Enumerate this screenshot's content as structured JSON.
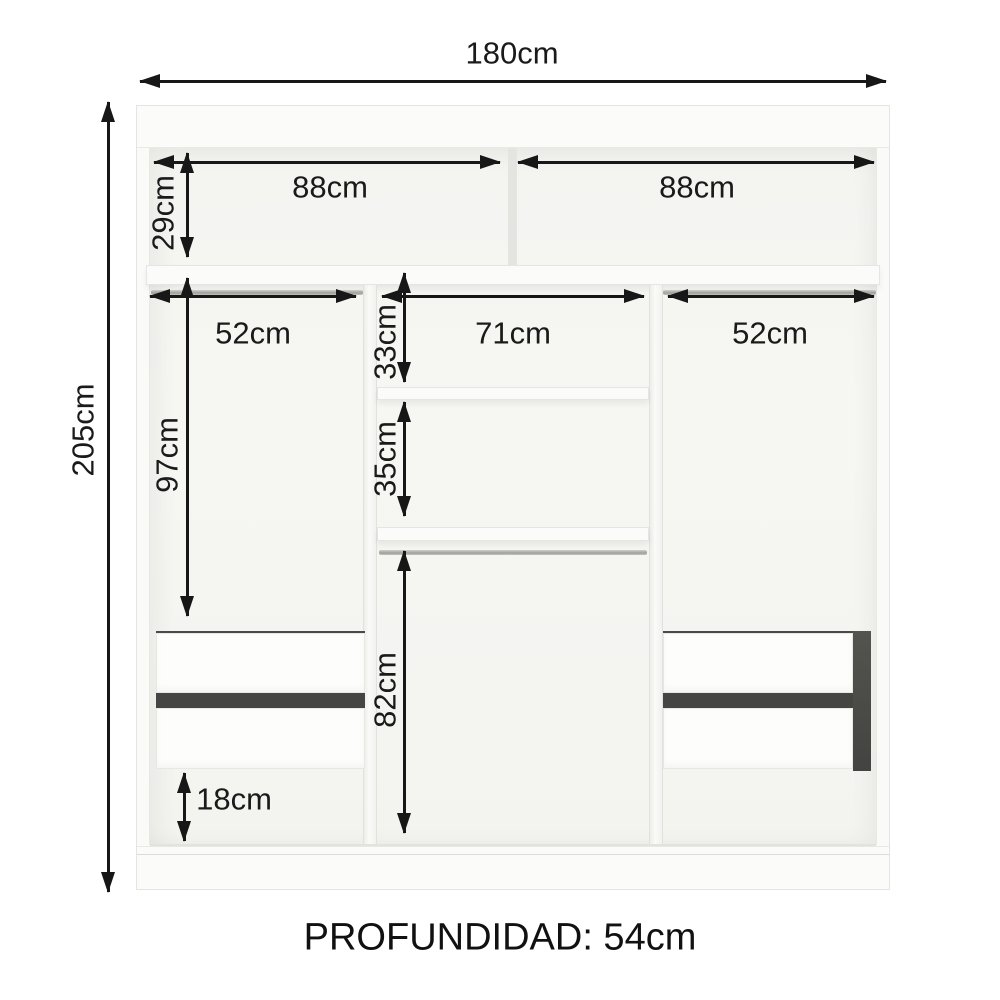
{
  "diagram": {
    "depth_caption": "PROFUNDIDAD: 54cm",
    "dimensions": {
      "overall_width": "180cm",
      "overall_height": "205cm",
      "top_shelf_left_width": "88cm",
      "top_shelf_right_width": "88cm",
      "top_shelf_height": "29cm",
      "left_section_width": "52cm",
      "middle_section_width": "71cm",
      "right_section_width": "52cm",
      "middle_upper_shelf_height": "33cm",
      "middle_lower_shelf_height": "35cm",
      "left_hanging_height": "97cm",
      "middle_hanging_height": "82cm",
      "bottom_compartment_height": "18cm"
    },
    "colors": {
      "arrow": "#171717",
      "text": "#1a1a1a",
      "cabinet_face": "#fbfbf9",
      "cabinet_interior": "#f5f5f2",
      "drawer_gap": "#454543",
      "rod": "#b5b5b2",
      "background": "#ffffff"
    }
  }
}
